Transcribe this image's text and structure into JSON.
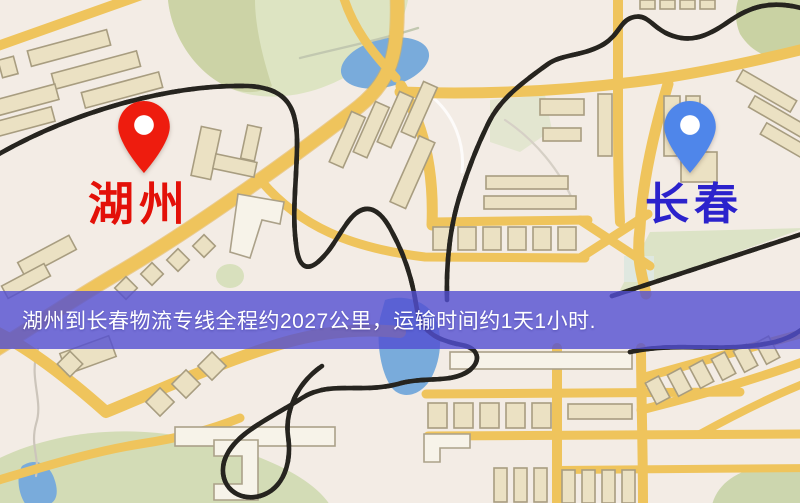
{
  "map": {
    "type": "logistics-route-map",
    "origin": {
      "label": "湖州",
      "pin_color": "#ee1c0e",
      "label_color": "#e31008"
    },
    "destination": {
      "label": "长春",
      "pin_color": "#4f86ea",
      "label_color": "#2b22cc"
    },
    "banner": {
      "text": "湖州到长春物流专线全程约2027公里，运输时间约1天1小时.",
      "background_color": "#534fd2",
      "text_color": "#ffffff",
      "distance_km": "2027",
      "duration": "1天1小时"
    },
    "colors": {
      "map_background": "#f3ece5",
      "road": "#efc45c",
      "building": "#ebe1c3",
      "water": "#79abdb",
      "park": "#d5deb8",
      "railway": "#26241f"
    }
  }
}
